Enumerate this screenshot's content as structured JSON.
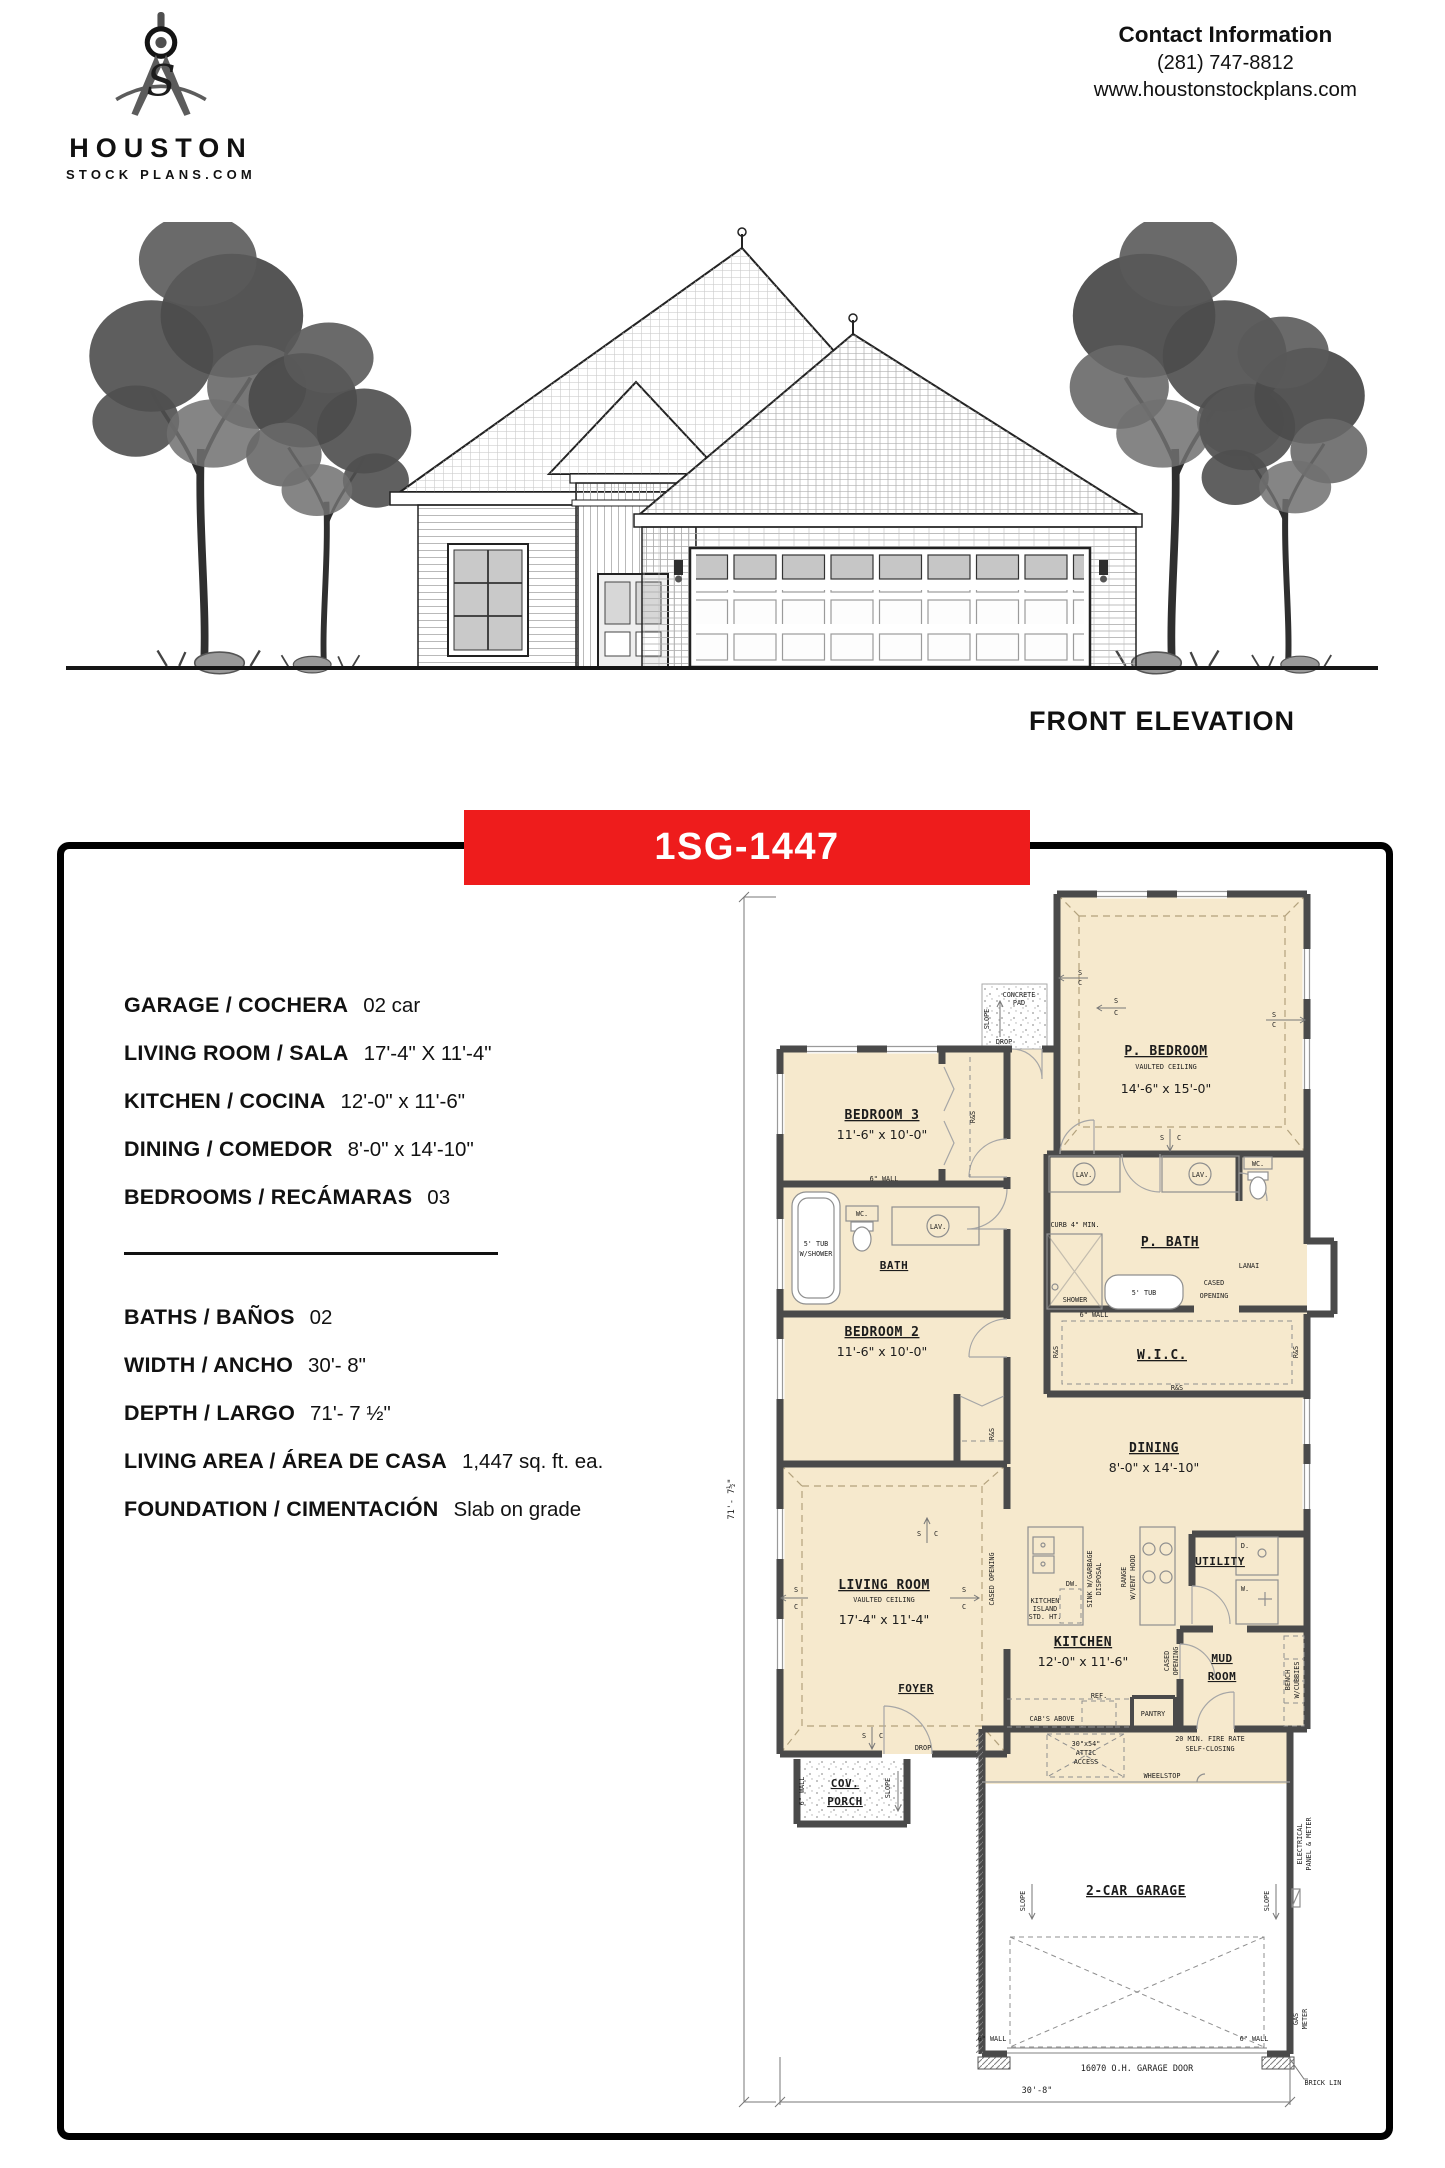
{
  "colors": {
    "accent": "#ee1c1c",
    "plan_fill": "#f6e9cd",
    "wall": "#4a4a4a"
  },
  "header": {
    "logo": {
      "name": "HOUSTON",
      "domain": "STOCK PLANS.COM",
      "monogram": "S"
    },
    "contact": {
      "title": "Contact Information",
      "phone": "(281) 747-8812",
      "website": "www.houstonstockplans.com"
    }
  },
  "elevation": {
    "caption": "FRONT ELEVATION"
  },
  "plan_card": {
    "plan_number": "1SG-1447",
    "accent_color": "#ee1c1c",
    "specs_primary": [
      {
        "label": "GARAGE / COCHERA",
        "value": "02 car"
      },
      {
        "label": "LIVING ROOM / SALA",
        "value": "17'-4\" X 11'-4\""
      },
      {
        "label": "KITCHEN / COCINA",
        "value": "12'-0\" x 11'-6\""
      },
      {
        "label": "DINING / COMEDOR",
        "value": "8'-0\" x 14'-10\""
      },
      {
        "label": "BEDROOMS / RECÁMARAS",
        "value": "03"
      }
    ],
    "specs_secondary": [
      {
        "label": "BATHS / BAÑOS",
        "value": "02"
      },
      {
        "label": "WIDTH / ANCHO",
        "value": "30'- 8\""
      },
      {
        "label": "DEPTH / LARGO",
        "value": "71'- 7 ½\""
      },
      {
        "label": "LIVING AREA / ÁREA DE CASA",
        "value": "1,447 sq. ft. ea."
      },
      {
        "label": "FOUNDATION / CIMENTACIÓN",
        "value": "Slab on grade"
      }
    ]
  },
  "floor_plan": {
    "dim_depth": "71'- 7½\"",
    "dim_width": "30'-8\"",
    "rooms": {
      "p_bedroom": {
        "name": "P. BEDROOM",
        "ceiling": "VAULTED CEILING",
        "dims": "14'-6\" x 15'-0\""
      },
      "bedroom3": {
        "name": "BEDROOM 3",
        "dims": "11'-6\" x 10'-0\""
      },
      "bedroom2": {
        "name": "BEDROOM 2",
        "dims": "11'-6\" x 10'-0\""
      },
      "bath": {
        "name": "BATH"
      },
      "p_bath": {
        "name": "P. BATH"
      },
      "wic": {
        "name": "W.I.C."
      },
      "dining": {
        "name": "DINING",
        "dims": "8'-0\" x 14'-10\""
      },
      "living": {
        "name": "LIVING ROOM",
        "ceiling": "VAULTED CEILING",
        "dims": "17'-4\" x 11'-4\""
      },
      "kitchen": {
        "name": "KITCHEN",
        "dims": "12'-0\" x 11'-6\""
      },
      "utility": {
        "name": "UTILITY"
      },
      "mud_1": "MUD",
      "mud_2": "ROOM",
      "foyer": {
        "name": "FOYER"
      },
      "porch_1": "COV.",
      "porch_2": "PORCH",
      "garage": {
        "name": "2-CAR GARAGE"
      }
    },
    "labels": {
      "concrete_1": "CONCRETE",
      "concrete_2": "PAD",
      "drop": "DROP",
      "slope": "SLOPE",
      "s": "S",
      "c": "C",
      "rs": "R&S",
      "wall6": "6\" WALL",
      "tub_shower_1": "5' TUB",
      "tub_shower_2": "W/SHOWER",
      "wc": "WC.",
      "lav": "LAV.",
      "curb": "CURB 4\" MIN.",
      "shower": "SHOWER",
      "tub5": "5' TUB",
      "cased": "CASED OPENING",
      "cased_1": "CASED",
      "cased_2": "OPENING",
      "lanai": "LANAI",
      "island_1": "KITCHEN",
      "island_2": "ISLAND",
      "island_3": "STD. HT.",
      "dw": "DW.",
      "sink_1": "SINK W/GARBAGE",
      "sink_2": "DISPOSAL",
      "range_1": "RANGE",
      "range_2": "W/VENT HOOD",
      "cabs": "CAB'S ABOVE",
      "ref": "REF.",
      "pantry": "PANTRY",
      "d": "D.",
      "w": "W.",
      "bench_1": "BENCH",
      "bench_2": "W/CUBBIES",
      "fire_1": "20 MIN. FIRE RATE",
      "fire_2": "SELF-CLOSING",
      "wheelstop": "WHEELSTOP",
      "attic_1": "30\"x54\"",
      "attic_2": "ATTIC",
      "attic_3": "ACCESS",
      "garage_door": "16070 O.H. GARAGE DOOR",
      "gas_1": "GAS",
      "gas_2": "METER",
      "elec_1": "ELECTRICAL",
      "elec_2": "PANEL & METER",
      "brick": "BRICK LINE"
    }
  }
}
